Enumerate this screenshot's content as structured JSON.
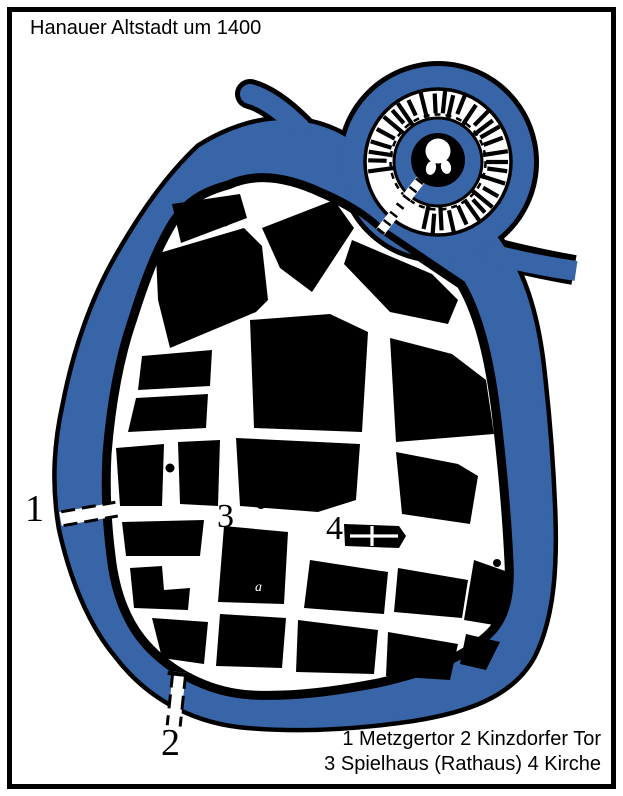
{
  "title": "Hanauer Altstadt um 1400",
  "legend": {
    "line1": "1 Metzgertor 2 Kinzdorfer Tor",
    "line2": "3 Spielhaus (Rathaus) 4 Kirche"
  },
  "landmarks": [
    {
      "number": "1",
      "name": "Metzgertor"
    },
    {
      "number": "2",
      "name": "Kinzdorfer Tor"
    },
    {
      "number": "3",
      "name": "Spielhaus (Rathaus)"
    },
    {
      "number": "4",
      "name": "Kirche"
    }
  ],
  "map_labels": {
    "gate_west": "1",
    "gate_south": "2",
    "spielhaus": "3",
    "kirche": "4",
    "annotation": "a"
  },
  "colors": {
    "water": "#3765A7",
    "ink": "#000000",
    "paper": "#FFFFFF"
  }
}
